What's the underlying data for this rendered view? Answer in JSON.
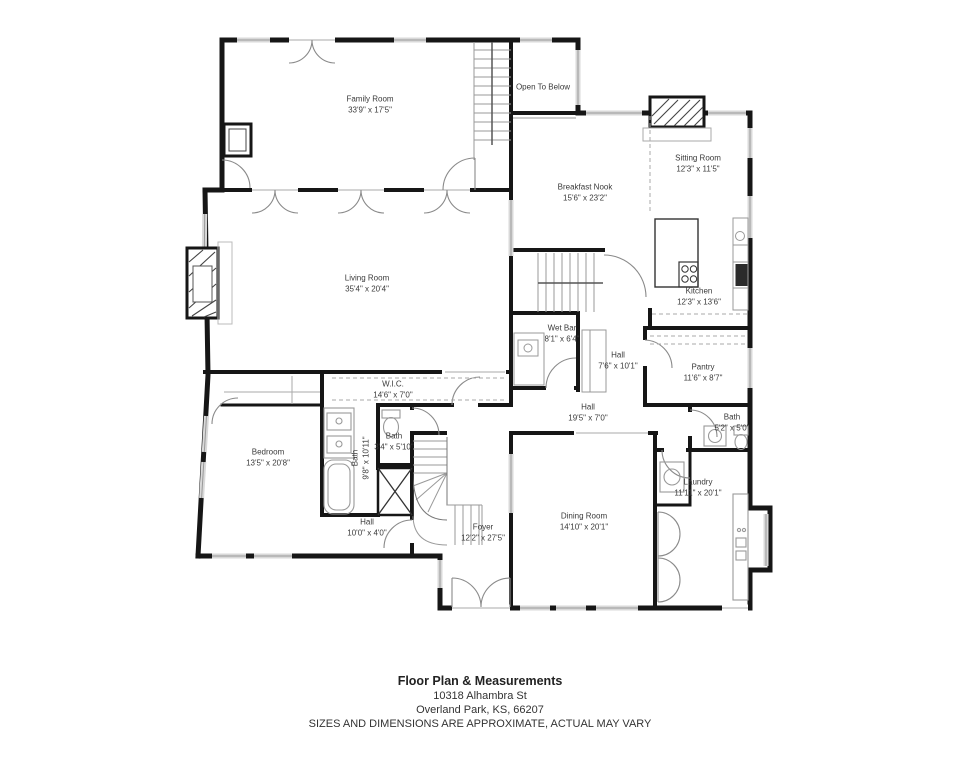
{
  "footer": {
    "title": "Floor Plan & Measurements",
    "address_line1": "10318 Alhambra St",
    "address_line2": "Overland Park, KS, 66207",
    "disclaimer": "SIZES AND DIMENSIONS ARE APPROXIMATE, ACTUAL MAY VARY"
  },
  "rooms": [
    {
      "id": "family-room",
      "name": "Family Room",
      "dims": "33'9\" x 17'5\""
    },
    {
      "id": "open-to-below",
      "name": "Open To Below",
      "dims": ""
    },
    {
      "id": "sitting-room",
      "name": "Sitting Room",
      "dims": "12'3\" x 11'5\""
    },
    {
      "id": "breakfast-nook",
      "name": "Breakfast Nook",
      "dims": "15'6\" x 23'2\""
    },
    {
      "id": "living-room",
      "name": "Living Room",
      "dims": "35'4\" x 20'4\""
    },
    {
      "id": "kitchen",
      "name": "Kitchen",
      "dims": "12'3\" x 13'6\""
    },
    {
      "id": "wet-bar",
      "name": "Wet Bar",
      "dims": "8'1\" x 6'4\""
    },
    {
      "id": "hall-upper",
      "name": "Hall",
      "dims": "7'6\" x 10'1\""
    },
    {
      "id": "pantry",
      "name": "Pantry",
      "dims": "11'6\" x 8'7\""
    },
    {
      "id": "wic",
      "name": "W.I.C.",
      "dims": "14'6\" x 7'0\""
    },
    {
      "id": "hall-middle",
      "name": "Hall",
      "dims": "19'5\" x 7'0\""
    },
    {
      "id": "bath-hall",
      "name": "Bath",
      "dims": "5'2\" x 5'0\""
    },
    {
      "id": "bath-secondary",
      "name": "Bath",
      "dims": "3'4\" x 5'10\""
    },
    {
      "id": "bath-primary",
      "name": "Bath",
      "dims": "9'8\" x 10'11\""
    },
    {
      "id": "bedroom",
      "name": "Bedroom",
      "dims": "13'5\" x 20'8\""
    },
    {
      "id": "laundry",
      "name": "Laundry",
      "dims": "11'11\" x 20'1\""
    },
    {
      "id": "hall-lower",
      "name": "Hall",
      "dims": "10'0\" x 4'0\""
    },
    {
      "id": "foyer",
      "name": "Foyer",
      "dims": "12'2\" x 27'5\""
    },
    {
      "id": "dining-room",
      "name": "Dining Room",
      "dims": "14'10\" x 20'1\""
    }
  ],
  "palette": {
    "wall": "#161616",
    "fixture_line": "#909090",
    "window_fill": "#d9d9d9",
    "label_text": "#3a3a3a",
    "background": "#ffffff"
  }
}
